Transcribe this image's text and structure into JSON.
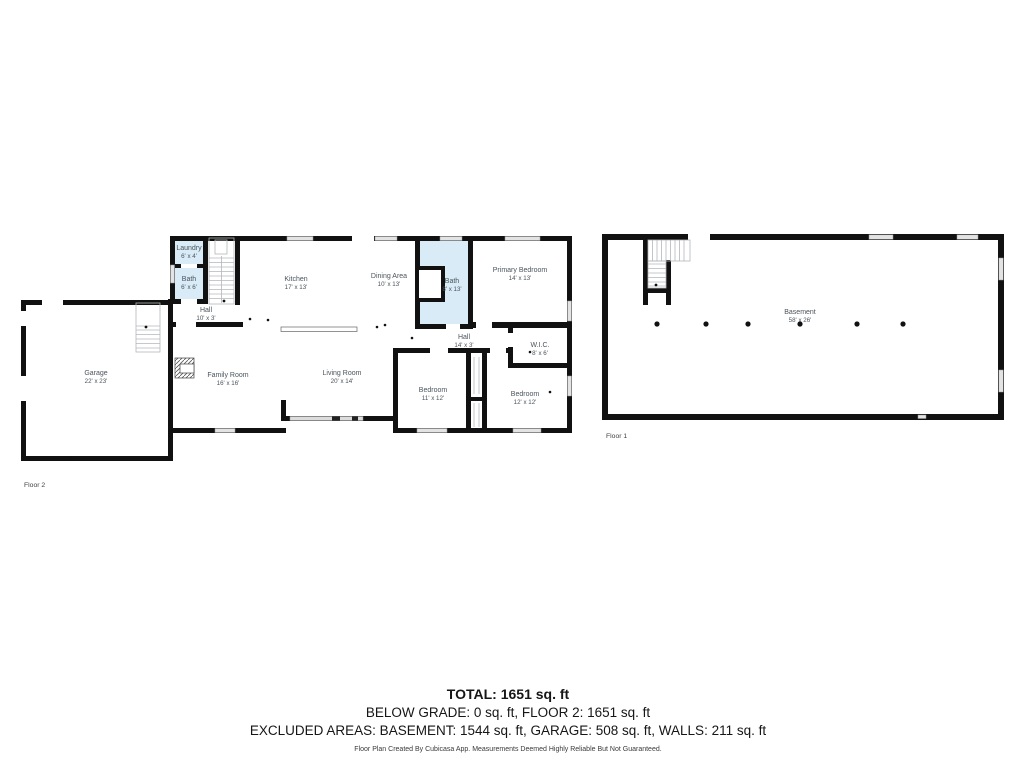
{
  "floors": {
    "floor2": {
      "label": "Floor 2",
      "rooms": [
        {
          "name": "Laundry",
          "dims": "6' x 4'"
        },
        {
          "name": "Bath",
          "dims": "6' x 6'"
        },
        {
          "name": "Hall",
          "dims": "10' x 3'"
        },
        {
          "name": "Kitchen",
          "dims": "17' x 13'"
        },
        {
          "name": "Dining Area",
          "dims": "10' x 13'"
        },
        {
          "name": "Bath",
          "dims": "8' x 13'"
        },
        {
          "name": "Primary Bedroom",
          "dims": "14' x 13'"
        },
        {
          "name": "Hall",
          "dims": "14' x 3'"
        },
        {
          "name": "W.I.C.",
          "dims": "8' x 6'"
        },
        {
          "name": "Garage",
          "dims": "22' x 23'"
        },
        {
          "name": "Family Room",
          "dims": "16' x 16'"
        },
        {
          "name": "Living Room",
          "dims": "20' x 14'"
        },
        {
          "name": "Bedroom",
          "dims": "11' x 12'"
        },
        {
          "name": "Bedroom",
          "dims": "12' x 12'"
        }
      ]
    },
    "floor1": {
      "label": "Floor 1",
      "rooms": [
        {
          "name": "Basement",
          "dims": "58' x 26'"
        }
      ]
    }
  },
  "summary": {
    "total": "TOTAL: 1651 sq. ft",
    "line2": "BELOW GRADE: 0 sq. ft, FLOOR 2: 1651 sq. ft",
    "line3": "EXCLUDED AREAS: BASEMENT: 1544 sq. ft, GARAGE: 508 sq. ft, WALLS: 211 sq. ft",
    "disclaimer": "Floor Plan Created By Cubicasa App. Measurements Deemed Highly Reliable But Not Guaranteed."
  },
  "colors": {
    "wall": "#111111",
    "wet_room_fill": "#d8ebf6",
    "window_fill": "#e3e3e3",
    "label_text": "#4a545c",
    "background": "#ffffff"
  }
}
